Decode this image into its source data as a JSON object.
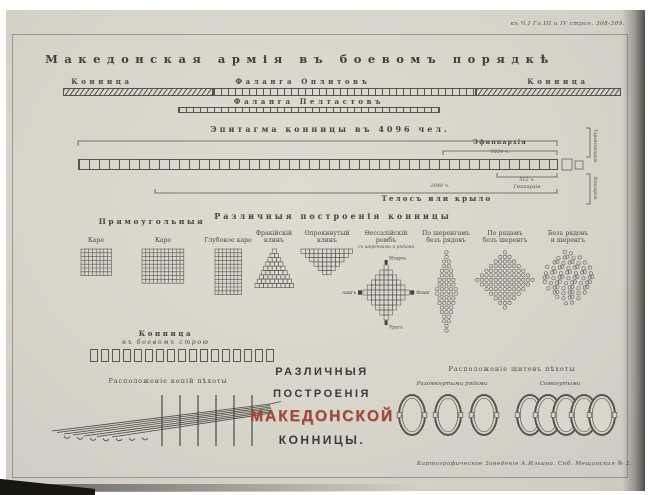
{
  "plate": {
    "corner_ref": "къ Ч.I Гл.III и IV стран. 308-309.",
    "imprint": "Картографическое Заведеніе А.Ильина. Спб. Мещанская № 2."
  },
  "battle_order": {
    "title": "Македонская армія въ боевомъ порядкѣ",
    "left_cavalry": "Конница",
    "hoplites": "Фаланга Оплитовъ",
    "right_cavalry": "Конница",
    "peltasts": "Фаланга Пелтастовъ"
  },
  "epitagma": {
    "title": "Эпитагма конницы въ 4096 чел.",
    "ephipparchia": "Эфиппархія",
    "ephipparchia_count": "1024 ч.",
    "hipparchia_count": "512 ч.",
    "hipparchia": "Гиппархія",
    "telos_count": "2048 ч.",
    "telos": "Телосъ или крыло",
    "vertical_top": "Тарантинархія",
    "vertical_bottom": "Эпилархія",
    "cells": 48
  },
  "formations": {
    "rect_heading": "Прямоугольныя",
    "heading": "Различныя построенія конницы",
    "items": [
      {
        "label": "Каре",
        "type": "grid",
        "cols": 8,
        "rows": 7
      },
      {
        "label": "Каре",
        "type": "grid",
        "cols": 11,
        "rows": 9
      },
      {
        "label": "Глубокое каре",
        "type": "grid",
        "cols": 7,
        "rows": 12
      },
      {
        "label": "Фракійскій\nклинъ",
        "type": "wedge",
        "rows": [
          1,
          2,
          3,
          4,
          5,
          6,
          7,
          8,
          9
        ]
      },
      {
        "label": "Опрокинутый\nклинъ",
        "type": "wedge",
        "rows": [
          12,
          10,
          8,
          6,
          4,
          2
        ]
      },
      {
        "label": "Ѳессалійскій\nромбъ",
        "sub": "съ шеренгами и рядами",
        "type": "rhombus",
        "rows": [
          1,
          3,
          5,
          7,
          9,
          11,
          9,
          7,
          5,
          3,
          1
        ],
        "corners": {
          "top": "Илархъ",
          "bottom": "Урагъ",
          "left": "Флангъ",
          "right": "Флангъ"
        }
      },
      {
        "label": "По шеренгамъ\nбезъ рядовъ",
        "type": "dots",
        "rows": [
          1,
          1,
          2,
          2,
          3,
          3,
          4,
          4,
          5,
          5,
          4,
          4,
          3,
          3,
          2,
          2,
          1,
          1
        ]
      },
      {
        "label": "По рядамъ\nбезъ шеренгъ",
        "type": "dots",
        "rows": [
          1,
          3,
          5,
          7,
          9,
          11,
          13,
          11,
          9,
          7,
          5,
          3,
          1
        ]
      },
      {
        "label": "Безъ рядовъ\nи шеренгъ",
        "type": "dots-irregular",
        "rows": [
          2,
          5,
          7,
          9,
          10,
          11,
          10,
          9,
          7,
          5,
          2
        ]
      }
    ]
  },
  "cavalry_line": {
    "title": "Конница",
    "subtitle": "въ боевомъ строю",
    "count": 17
  },
  "pikes": {
    "title": "Расположеніе копій пѣхоты"
  },
  "main_title": {
    "line1": "РАЗЛИЧНЫЯ",
    "line2": "ПОСТРОЕНІЯ",
    "line3": "МАКЕДОНСКОЙ",
    "line4": "КОННИЦЫ."
  },
  "shields": {
    "title": "Расположеніе щитовъ пѣхоты",
    "open_label": "Разомкнутыми рядами",
    "closed_label": "Сомкнутыми",
    "open_count": 3,
    "closed_count": 5
  },
  "colors": {
    "ink": "#45433c",
    "line": "#58564e",
    "red": "#a6473b",
    "paper": "#d8d5cb"
  }
}
